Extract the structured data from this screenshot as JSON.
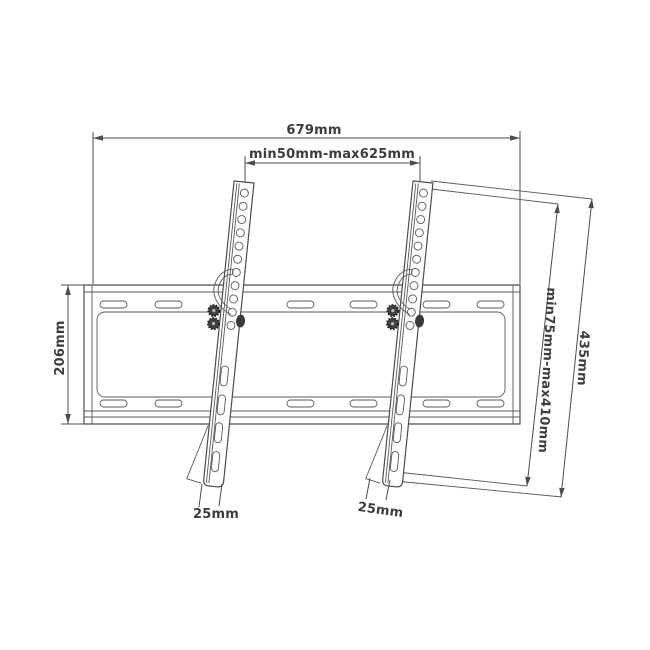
{
  "labels": {
    "total_width": "679mm",
    "mount_span_range": "min50mm-max625mm",
    "plate_height": "206mm",
    "vesa_height_range": "min75mm-max410mm",
    "arm_length": "435mm",
    "left_arm_width": "25mm",
    "right_arm_width": "25mm"
  },
  "colors": {
    "background": "#ffffff",
    "line": "#4d4d4d",
    "text": "#3d3d3d"
  }
}
